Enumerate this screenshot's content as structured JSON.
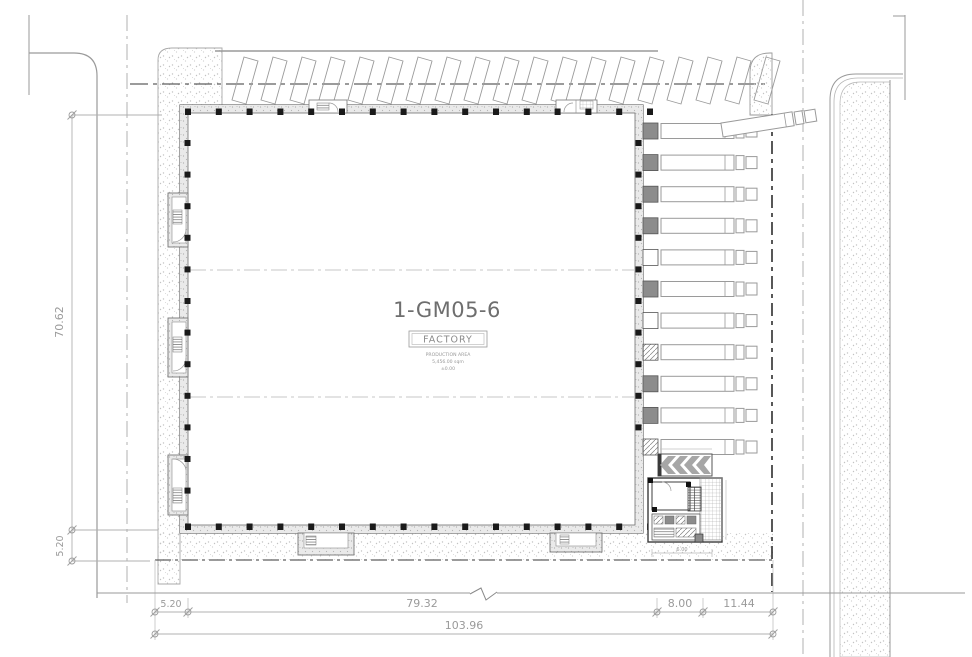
{
  "building": {
    "label": "1-GM05-6",
    "use_label": "FACTORY",
    "area_label": "PRODUCTION AREA",
    "area_value": "5,456.00 sqm",
    "level_value": "±0.00"
  },
  "dimensions": {
    "left_height": "70.62",
    "left_offset": "5.20",
    "bottom_offset": "5.20",
    "bottom_main": "79.32",
    "bottom_dock_apron": "8.00",
    "bottom_road": "11.44",
    "bottom_total": "103.96",
    "office_width": "6.00"
  },
  "site": {
    "truck_count": 11,
    "dock_doors": [
      "s",
      "s",
      "s",
      "s",
      "w",
      "s",
      "w",
      "h",
      "s",
      "s",
      "h"
    ],
    "parking_stall_count": 19,
    "colors": {
      "linework": "#9a9a9a",
      "walls": "#666666",
      "columns": "#1a1a1a",
      "dock_door": "#8c8c8c",
      "dim": "#a6a6a6",
      "dim_text": "#9a9a9a",
      "label_text": "#6e6e6e"
    }
  }
}
